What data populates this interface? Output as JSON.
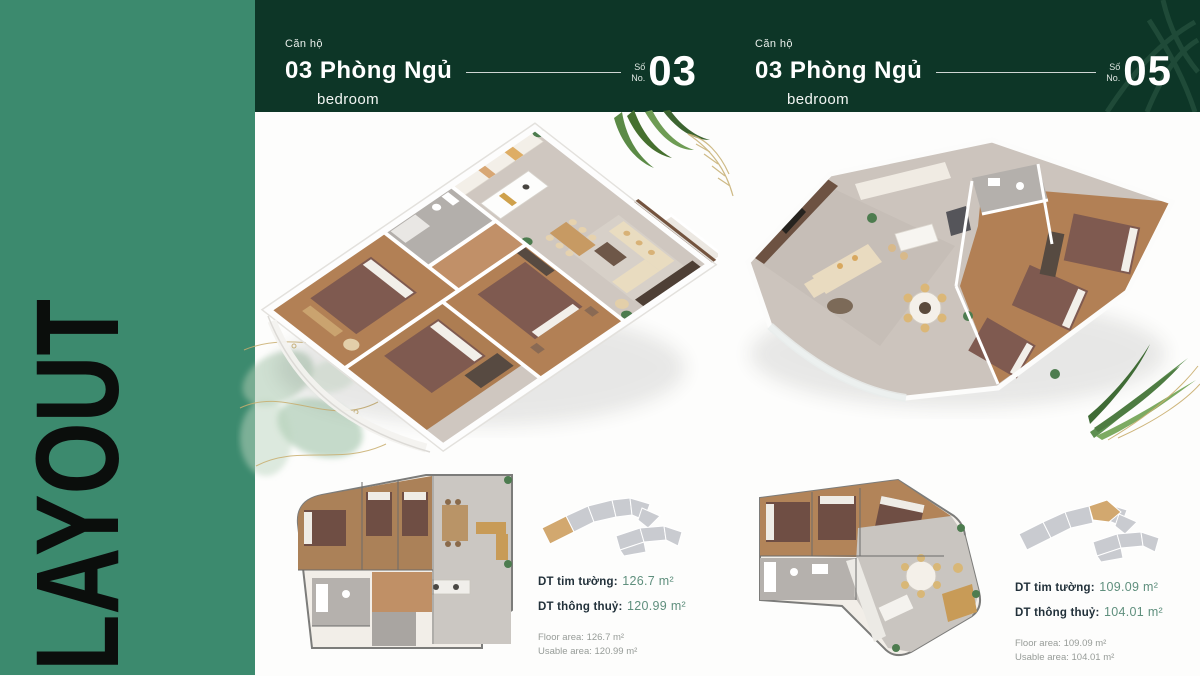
{
  "sidebar": {
    "title": "LAYOUT"
  },
  "units": [
    {
      "unit_label": "Căn hộ",
      "title": "03 Phòng Ngủ",
      "subtitle": "bedroom",
      "no_label_vi": "Số",
      "no_label_en": "No.",
      "number": "03",
      "metrics": {
        "wall_label": "DT tim tường:",
        "wall_value": "126.7 m²",
        "clear_label": "DT thông thuỷ:",
        "clear_value": "120.99 m²",
        "floor_area": "Floor area: 126.7 m²",
        "usable_area": "Usable area: 120.99 m²"
      }
    },
    {
      "unit_label": "Căn hộ",
      "title": "03 Phòng Ngủ",
      "subtitle": "bedroom",
      "no_label_vi": "Số",
      "no_label_en": "No.",
      "number": "05",
      "metrics": {
        "wall_label": "DT tim tường:",
        "wall_value": "109.09 m²",
        "clear_label": "DT thông thuỷ:",
        "clear_value": "104.01 m²",
        "floor_area": "Floor area: 109.09 m²",
        "usable_area": "Usable area: 104.01 m²"
      }
    }
  ],
  "colors": {
    "sidebar_green": "#3c8a6e",
    "band_green": "#0d3627",
    "accent_teal": "#5f8f7d",
    "highlight_tan": "#d2a86f"
  }
}
